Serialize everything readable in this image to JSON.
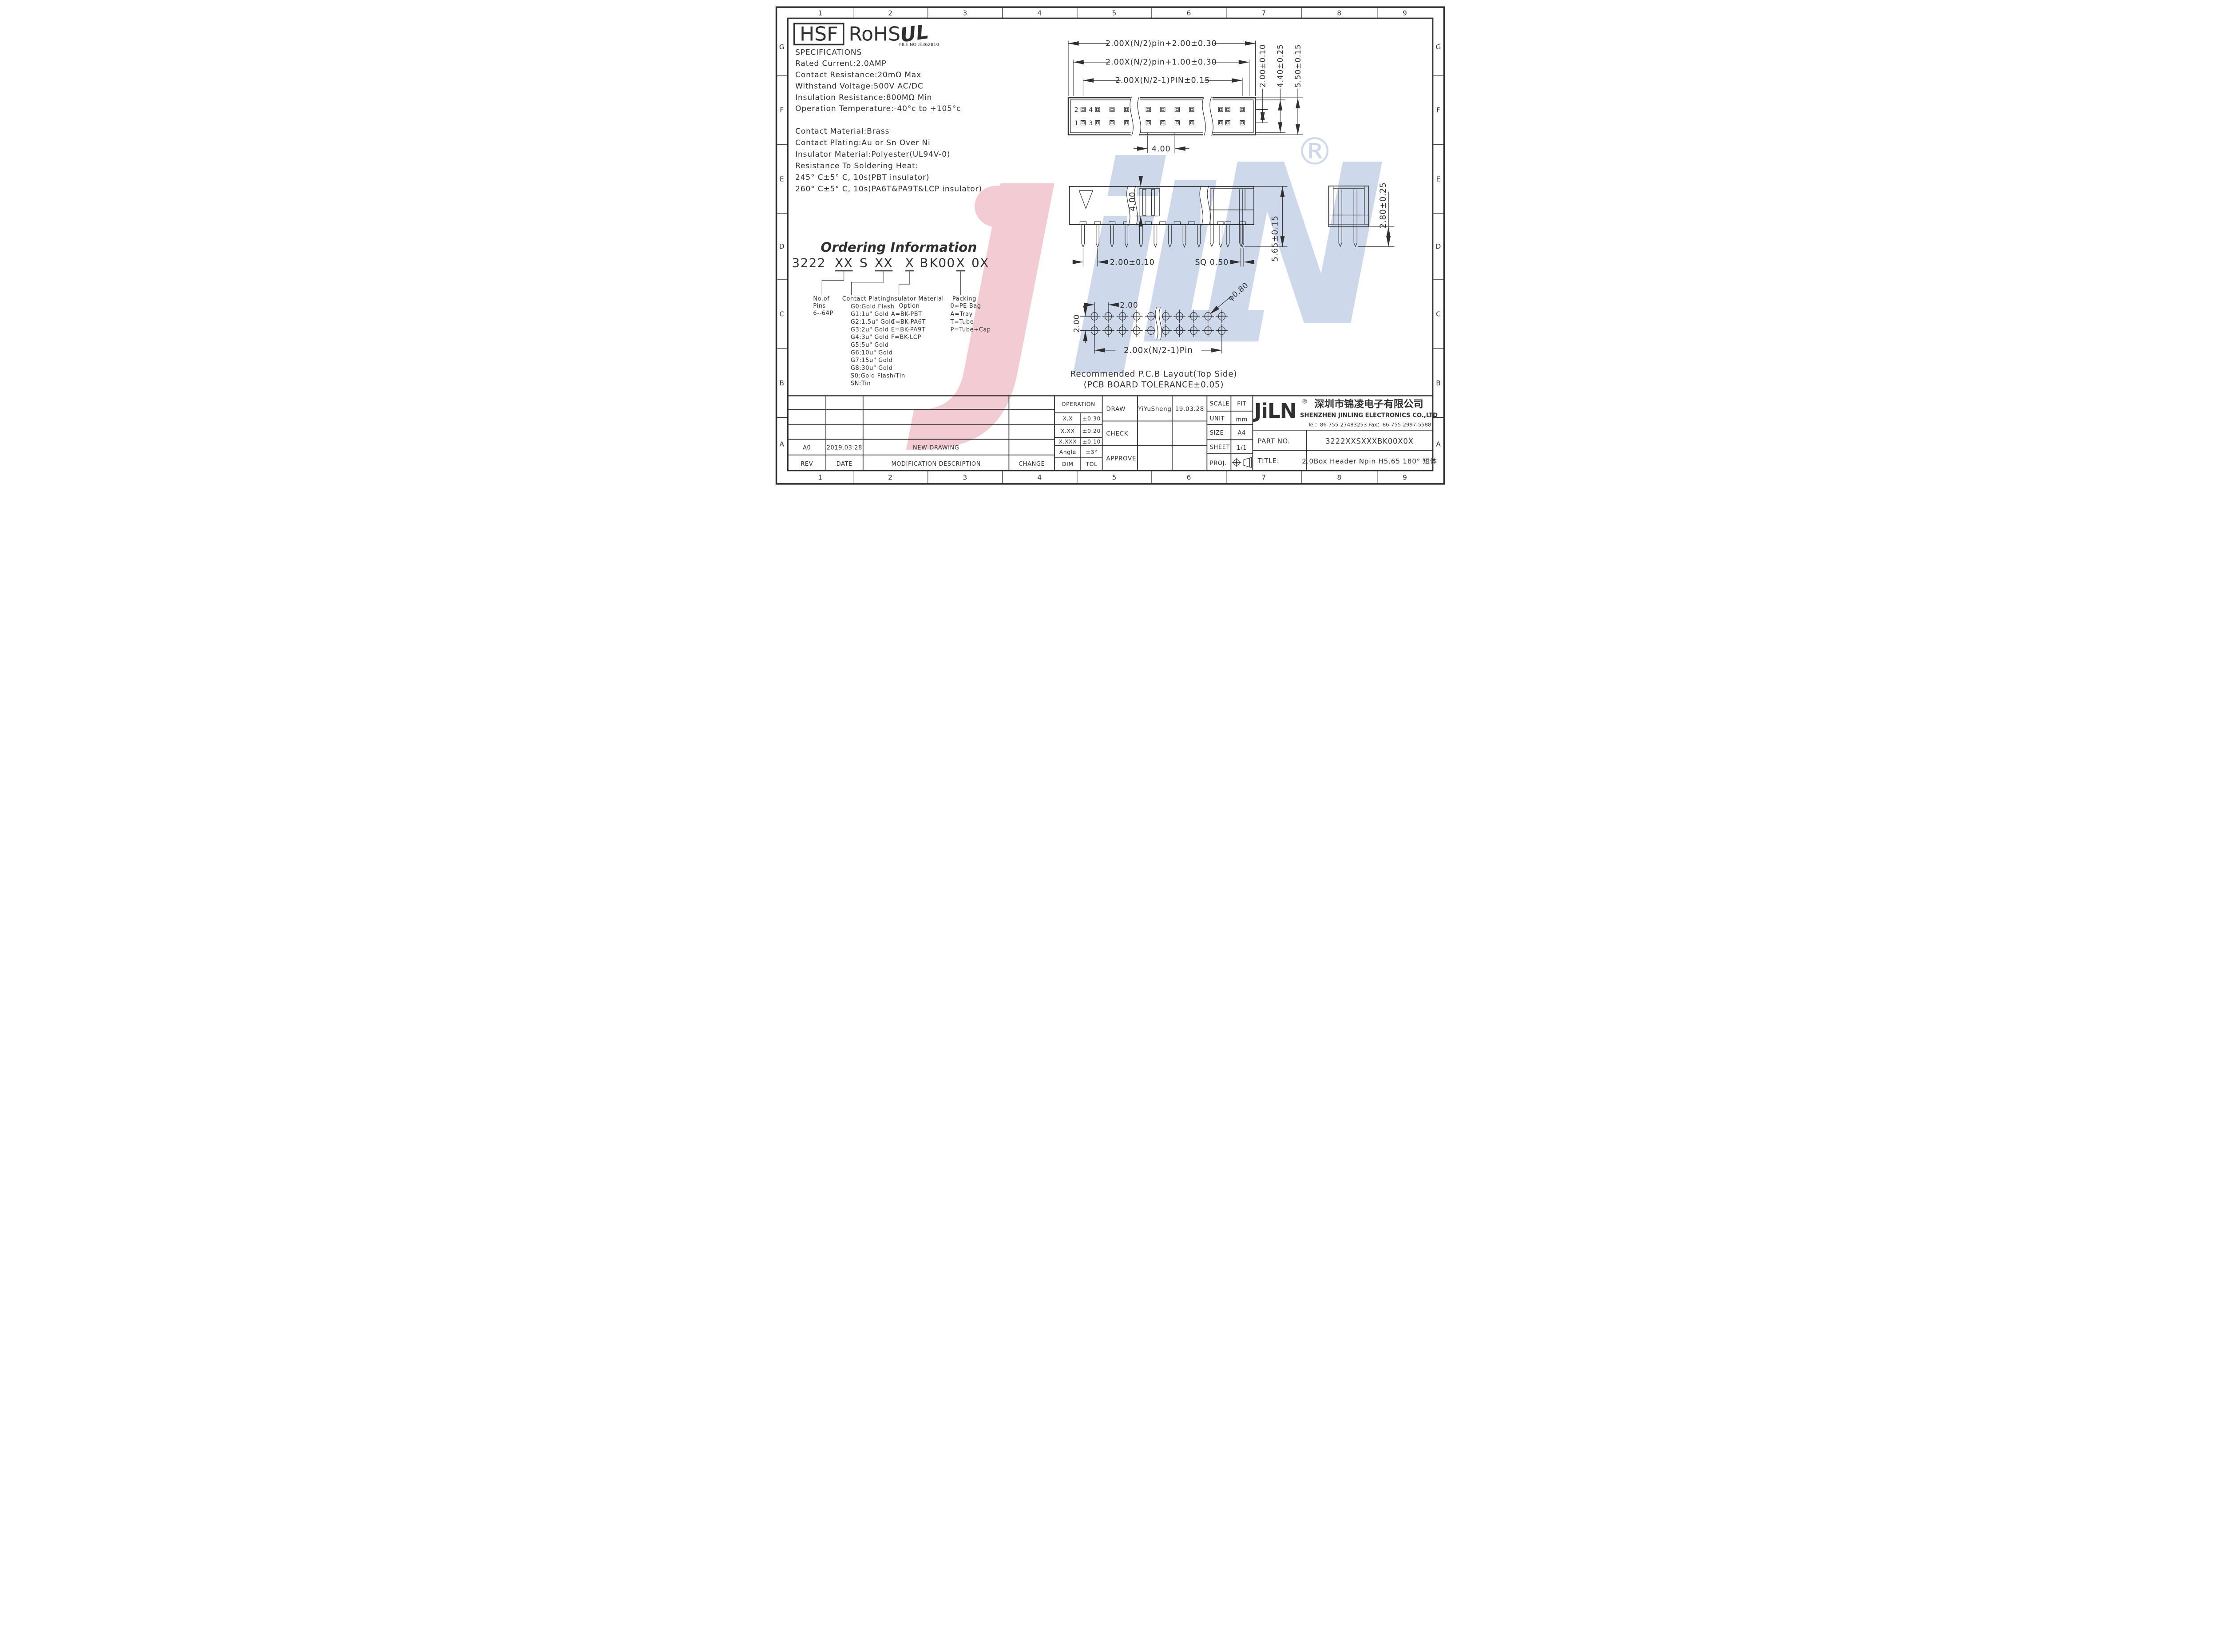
{
  "sheet": {
    "zones": {
      "cols": [
        "1",
        "2",
        "3",
        "4",
        "5",
        "6",
        "7",
        "8",
        "9"
      ],
      "rows": [
        "G",
        "F",
        "E",
        "D",
        "C",
        "B",
        "A"
      ]
    }
  },
  "certs": {
    "hsf": "HSF",
    "rohs": "RoHS",
    "ul": "UL",
    "file_no": "FILE NO :E362810"
  },
  "specs": {
    "title": "SPECIFICATIONS",
    "lines": [
      "Rated Current:2.0AMP",
      "Contact Resistance:20mΩ Max",
      "Withstand Voltage:500V AC/DC",
      "Insulation Resistance:800MΩ Min",
      "Operation Temperature:-40°c to +105°c"
    ]
  },
  "materials": {
    "lines": [
      "Contact Material:Brass",
      "Contact Plating:Au or Sn Over Ni",
      "Insulator Material:Polyester(UL94V-0)",
      "Resistance To Soldering Heat:",
      "245° C±5° C, 10s(PBT insulator)",
      "260° C±5° C, 10s(PA6T&PA9T&LCP insulator)"
    ]
  },
  "ordering": {
    "title": "Ordering Information",
    "code": [
      "3222",
      "XX",
      "S",
      "XX",
      "X",
      "B",
      "K00",
      "X",
      "0X"
    ],
    "pins_col": {
      "l1": "No.of",
      "l2": "Pins",
      "l3": "6--64P"
    },
    "plating_col": {
      "header": "Contact Plating",
      "items": [
        "G0:Gold Flash",
        "G1:1u\" Gold",
        "G2:1.5u\" Gold",
        "G3:2u\" Gold",
        "G4:3u\" Gold",
        "G5:5u\" Gold",
        "G6:10u\" Gold",
        "G7:15u\" Gold",
        "G8:30u\" Gold",
        "S0:Gold Flash/Tin",
        "SN:Tin"
      ]
    },
    "insulator_col": {
      "h1": "Insulator Material",
      "h2": "Option",
      "items": [
        "A=BK-PBT",
        "C=BK-PA6T",
        "E=BK-PA9T",
        "F=BK-LCP"
      ]
    },
    "packing_col": {
      "header": "Packing",
      "items": [
        "0=PE Bag",
        "A=Tray",
        "T=Tube",
        "P=Tube+Cap"
      ]
    }
  },
  "top_view": {
    "dim_overall": "2.00X(N/2)pin+2.00±0.30",
    "dim_inner": "2.00X(N/2)pin+1.00±0.30",
    "dim_pins": "2.00X(N/2-1)PIN±0.15",
    "dim_row_pitch": "2.00±0.10",
    "dim_body_inner": "4.40±0.25",
    "dim_body_outer": "5.50±0.15",
    "dim_key": "4.00",
    "pin2": "2",
    "pin4": "4",
    "pin1": "1",
    "pin3": "3"
  },
  "side_view": {
    "dim_depth": "4.00",
    "dim_pitch": "2.00±0.10",
    "dim_sq": "SQ 0.50",
    "dim_height": "5.65±0.15"
  },
  "section_view": {
    "dim_tail": "2.80±0.25"
  },
  "pcb": {
    "dim_row": "2.00",
    "dim_col": "2.00",
    "dim_dia": "φ0.80",
    "dim_span": "2.00x(N/2-1)Pin",
    "caption1": "Recommended P.C.B Layout(Top Side)",
    "caption2": "(PCB BOARD TOLERANCE±0.05)"
  },
  "watermark": {
    "j": "J",
    "i": "i",
    "l": "L",
    "n": "N",
    "registered": "®",
    "pink": "#f3ccd3",
    "blue": "#cdd9eb"
  },
  "title_block": {
    "revision": {
      "rev": "A0",
      "date": "2019.03.28",
      "desc": "NEW DRAWING",
      "h_rev": "REV",
      "h_date": "DATE",
      "h_desc": "MODIFICATION DESCRIPTION",
      "h_change": "CHANGE"
    },
    "tolerance": {
      "header": "OPERATION",
      "r1d": "X.X",
      "r1t": "±0.30",
      "r2d": "X.XX",
      "r2t": "±0.20",
      "r3d": "X.XXX",
      "r3t": "±0.10",
      "r4d": "Angle",
      "r4t": "±3°",
      "fd": "DIM",
      "ft": "TOL"
    },
    "sign": {
      "draw": "DRAW",
      "draw_name": "YiYuSheng",
      "draw_date": "19.03.28",
      "check": "CHECK",
      "approve": "APPROVE"
    },
    "info": {
      "scale": "SCALE",
      "scale_v": "FIT",
      "unit": "UNIT",
      "unit_v": "mm",
      "size": "SIZE",
      "size_v": "A4",
      "sheet": "SHEET",
      "sheet_v": "1/1",
      "proj": "PROJ."
    },
    "company": {
      "logo": "JiLN",
      "registered": "®",
      "cn": "深圳市锦凌电子有限公司",
      "en": "SHENZHEN JINLING ELECTRONICS CO.,LTD",
      "tel": "Tel：86-755-27483253 Fax：86-755-2997-5588"
    },
    "part_label": "PART NO.",
    "part_value": "3222XXSXXXBK00X0X",
    "title_label": "TITLE:",
    "title_value": "2.0Box Header Npin H5.65 180° 短体"
  }
}
